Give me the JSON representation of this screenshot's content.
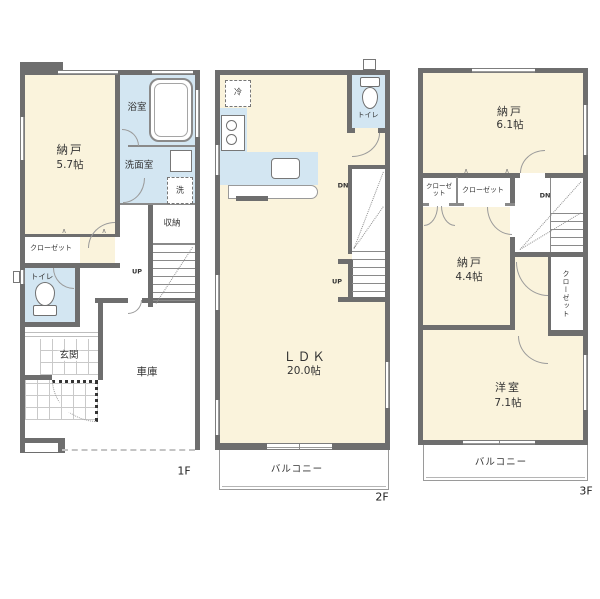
{
  "f1": {
    "tag": "1F",
    "nando_name": "納戸",
    "nando_size": "5.7帖",
    "bath": "浴室",
    "wash": "洗面室",
    "storage": "収納",
    "closet": "クローゼット",
    "toilet": "トイレ",
    "entrance": "玄関",
    "garage": "車庫",
    "washer": "洗",
    "up": "UP"
  },
  "f2": {
    "tag": "2F",
    "ldk_name": "ＬＤＫ",
    "ldk_size": "20.0帖",
    "toilet": "トイレ",
    "balcony": "バルコニー",
    "fridge": "冷",
    "dn": "DN",
    "up": "UP"
  },
  "f3": {
    "tag": "3F",
    "nando1_name": "納戸",
    "nando1_size": "6.1帖",
    "nando2_name": "納戸",
    "nando2_size": "4.4帖",
    "yoshitsu_name": "洋室",
    "yoshitsu_size": "7.1帖",
    "closet_small": "クローゼット",
    "closet_mid": "クローゼット",
    "closet_side": "クローゼット",
    "balcony": "バルコニー",
    "dn": "DN"
  },
  "icons": {
    "door_swing": "∧"
  },
  "colors": {
    "wall": "#6e6e6e",
    "room": "#FAF3DC",
    "wet": "#D3E6F2"
  }
}
